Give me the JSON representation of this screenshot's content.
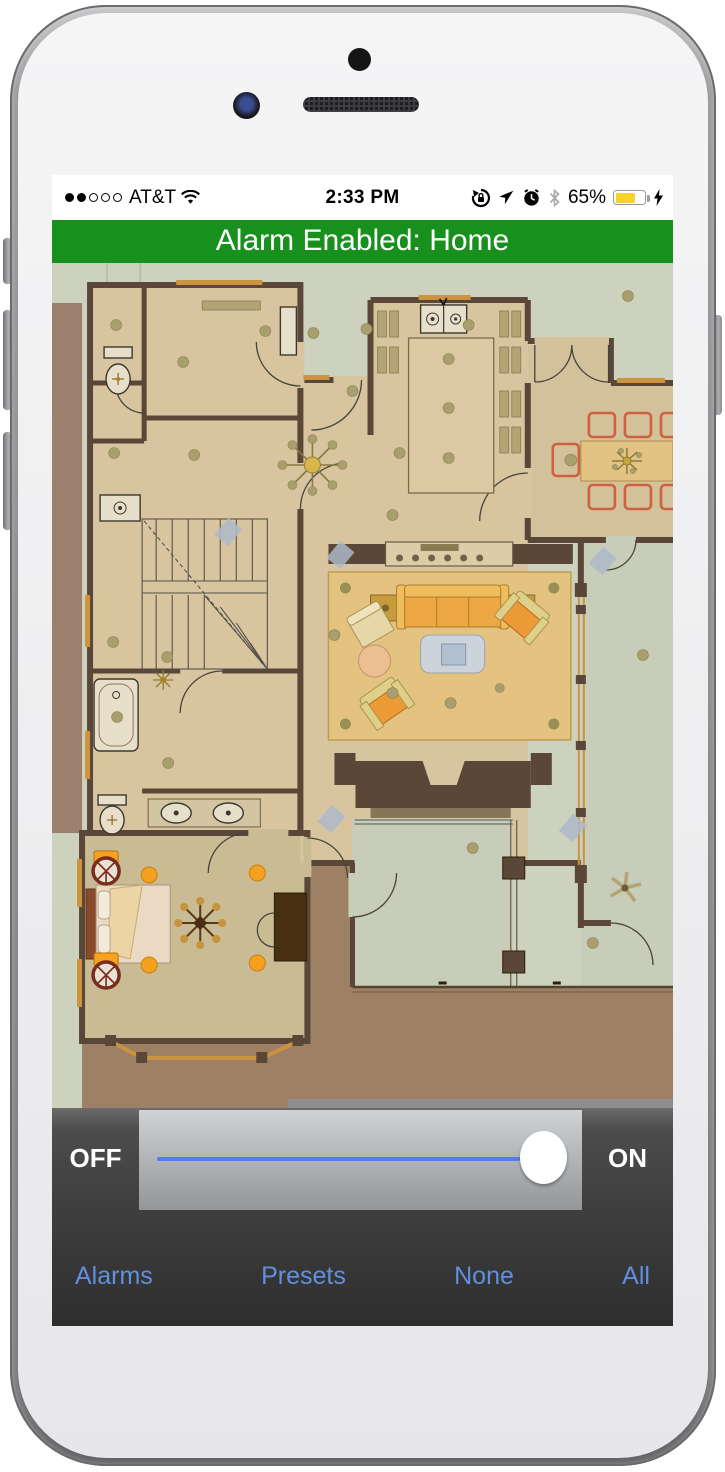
{
  "status_bar": {
    "signal_filled": 2,
    "signal_total": 5,
    "carrier": "AT&T",
    "time": "2:33 PM",
    "battery_percent": "65%",
    "icons": [
      "wifi-icon",
      "rotation-lock-icon",
      "location-icon",
      "alarm-clock-icon",
      "bluetooth-icon",
      "battery-icon",
      "charging-bolt-icon"
    ]
  },
  "banner": {
    "text": "Alarm Enabled: Home"
  },
  "slider": {
    "off_label": "OFF",
    "on_label": "ON",
    "state": "ON",
    "value_percent": 100
  },
  "toolbar": {
    "links": [
      "Alarms",
      "Presets",
      "None",
      "All"
    ]
  },
  "colors": {
    "banner-green": "#18901d",
    "link-blue": "#6090dd",
    "track-blue": "#4d7ef2",
    "battery-yellow": "#f5d327",
    "fp-sage": "#cdd2bf",
    "fp-pale": "#c7cdb8",
    "fp-mauve": "#9c7f6c",
    "fp-deck": "#9e8064",
    "fp-wall": "#5a4738",
    "fp-floor": "#d8c5a0",
    "fp-floor2": "#d3c19c",
    "fp-bed": "#c9bb93",
    "fp-rug": "#e4c380",
    "fp-dot": "#a89e6e",
    "fp-orange": "#f5a11f"
  }
}
